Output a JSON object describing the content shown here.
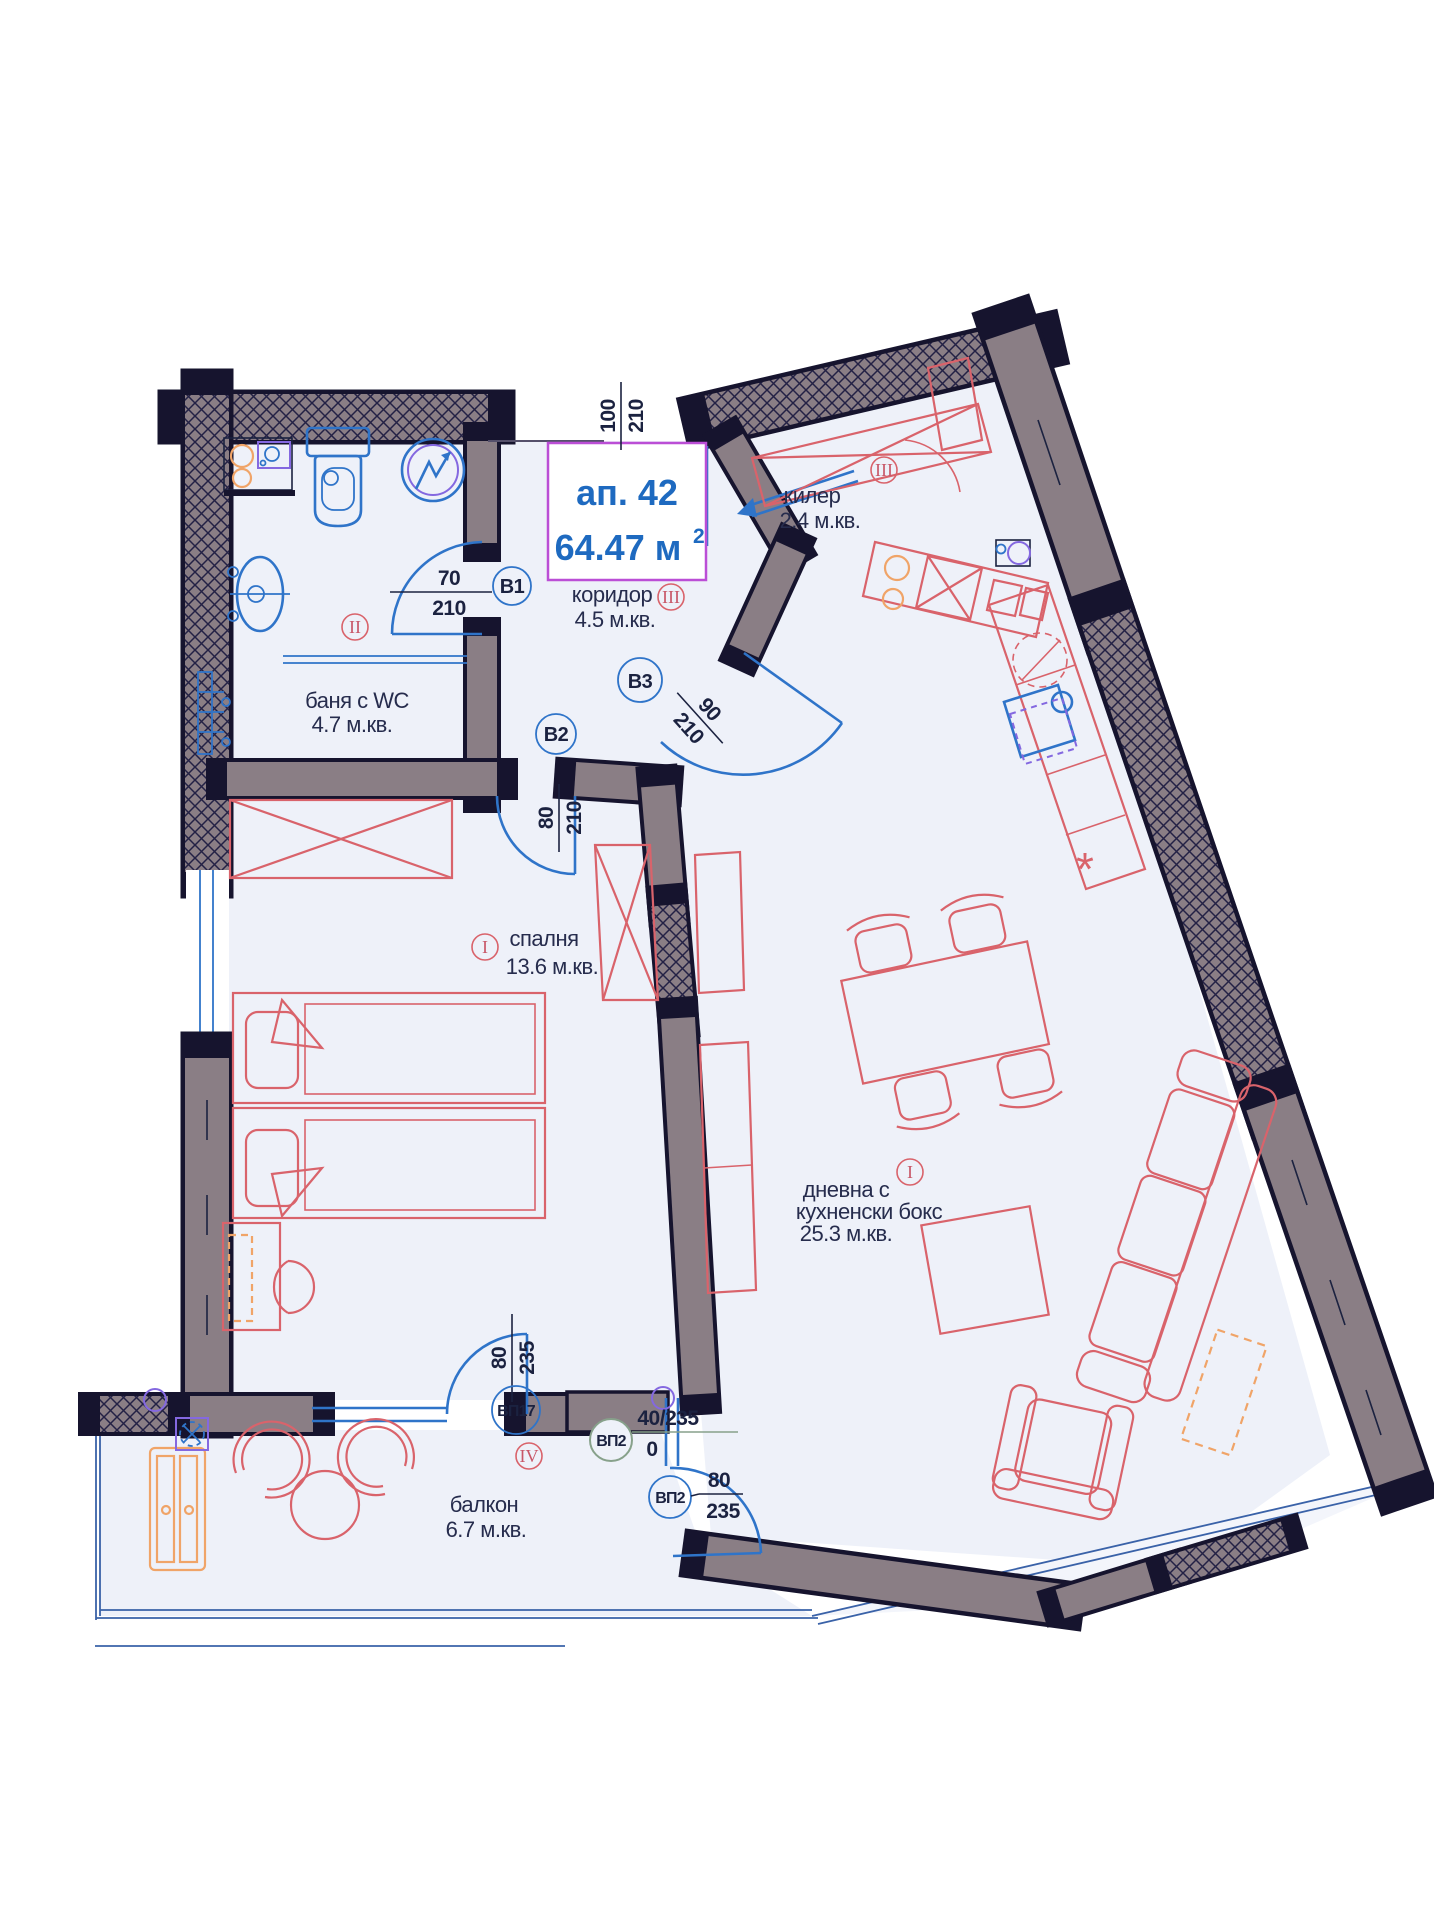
{
  "title_box": {
    "apartment": "ап. 42",
    "area_value": "64.47 м",
    "area_sup": "2"
  },
  "rooms": {
    "kiler": {
      "name": "килер",
      "area": "2.4 м.кв.",
      "numeral": "III"
    },
    "corridor": {
      "name": "коридор",
      "area": "4.5 м.кв.",
      "numeral": "III"
    },
    "bath": {
      "name": "баня с WC",
      "area": "4.7 м.кв.",
      "numeral": "II"
    },
    "bedroom": {
      "name": "спалня",
      "area": "13.6 м.кв.",
      "numeral": "I"
    },
    "living": {
      "name_line1": "дневна с",
      "name_line2": "кухненски бокс",
      "area": "25.3 м.кв.",
      "numeral": "I"
    },
    "balcony": {
      "name": "балкон",
      "area": "6.7 м.кв.",
      "numeral": "IV"
    }
  },
  "doors": {
    "b1": {
      "label": "B1",
      "num": "70",
      "den": "210"
    },
    "b2": {
      "label": "B2",
      "num": "80",
      "den": "210"
    },
    "b3": {
      "label": "B3",
      "num": "90",
      "den": "210"
    },
    "entry": {
      "num": "100",
      "den": "210"
    },
    "vp17": {
      "label": "ВП17",
      "num": "80",
      "den": "235"
    },
    "vp2a": {
      "label": "ВП2",
      "dim": "40/235",
      "extra": "0"
    },
    "vp2b": {
      "label": "ВП2",
      "num": "80",
      "den": "235"
    }
  },
  "colors": {
    "title_blue": "#1e6ac0",
    "title_border": "#bb4ed6",
    "wall_fill": "#8a7e85",
    "wall_outline": "#16142e",
    "fixture_blue": "#2f74c9",
    "furniture_red": "#d9636b",
    "numeral_red": "#c85768",
    "accent_orange": "#f0a468",
    "accent_purple": "#8468e0",
    "vp2a_green": "#87a18b",
    "floor": "#eef1f9"
  }
}
